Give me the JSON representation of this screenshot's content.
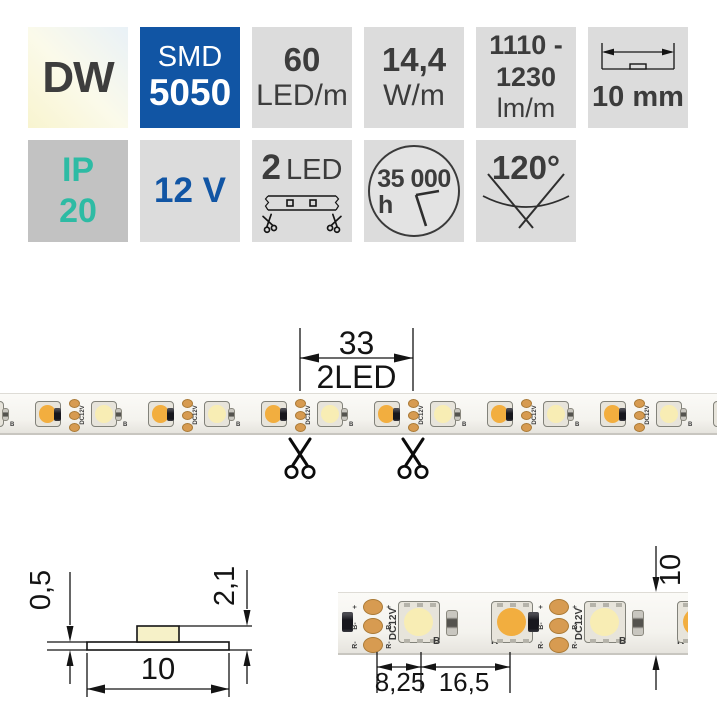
{
  "badges": {
    "dw": {
      "label": "DW"
    },
    "smd": {
      "line1": "SMD",
      "line2": "5050"
    },
    "density": {
      "value": "60",
      "unit": "LED/m"
    },
    "power": {
      "value": "14,4",
      "unit": "W/m"
    },
    "flux": {
      "line1": "1110 -",
      "line2": "1230",
      "unit": "lm/m"
    },
    "strip_width": {
      "label": "10 mm"
    },
    "ip": {
      "line1": "IP",
      "line2": "20"
    },
    "voltage": {
      "label": "12 V"
    },
    "cut": {
      "value": "2",
      "unit": "LED"
    },
    "lifetime": {
      "value": "35 000",
      "unit": "h"
    },
    "beam_angle": {
      "label": "120°"
    }
  },
  "cut_diagram": {
    "length_mm": "33",
    "segment_label": "2LED"
  },
  "cross_section": {
    "pcb_thickness": "0,5",
    "total_height": "2,1",
    "width_mm": "10"
  },
  "top_view": {
    "cut_to_led": "8,25",
    "led_pitch": "16,5",
    "width_mm": "10",
    "pcb_print": "DC12V",
    "label_b": "B",
    "label_r": "R",
    "pad_plus": "+",
    "pad_b": "B-",
    "pad_r": "R-"
  },
  "colors": {
    "accent_blue": "#1155a4",
    "accent_teal": "#2ebba4",
    "badge_gray": "#dcdcdc",
    "badge_gray_dark": "#c2c2c2",
    "warm_led": "#f2ae3f",
    "cool_led": "#f8edb4",
    "copper": "#d79b51"
  }
}
